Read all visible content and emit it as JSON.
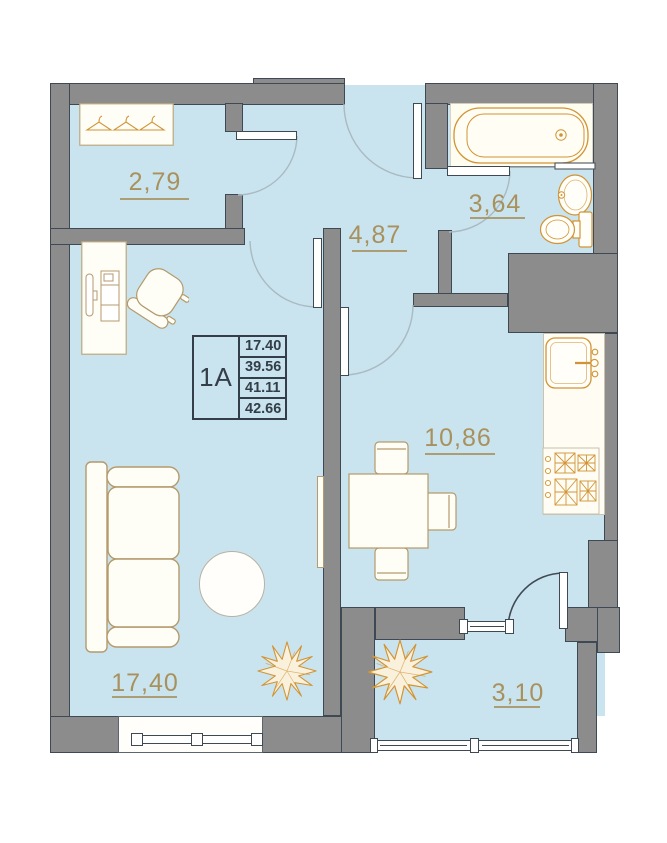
{
  "legend": {
    "unit": "1A",
    "rows": [
      "17.40",
      "39.56",
      "41.11",
      "42.66"
    ]
  },
  "rooms": [
    {
      "id": "wardrobe",
      "area": "2,79"
    },
    {
      "id": "hallway",
      "area": "4,87"
    },
    {
      "id": "bathroom",
      "area": "3,64"
    },
    {
      "id": "kitchen",
      "area": "10,86"
    },
    {
      "id": "living-room",
      "area": "17,40"
    },
    {
      "id": "balcony",
      "area": "3,10"
    }
  ],
  "colors": {
    "floor": "#c9e4ee",
    "wall": "#8c8c8c",
    "wall_outline": "#3e4953",
    "label_gold": "#a8915c",
    "fixture_orange": "#d29334",
    "furniture_tan": "#b49a6c",
    "legend_dark": "#333e48",
    "arc_light": "#a9bac1"
  }
}
